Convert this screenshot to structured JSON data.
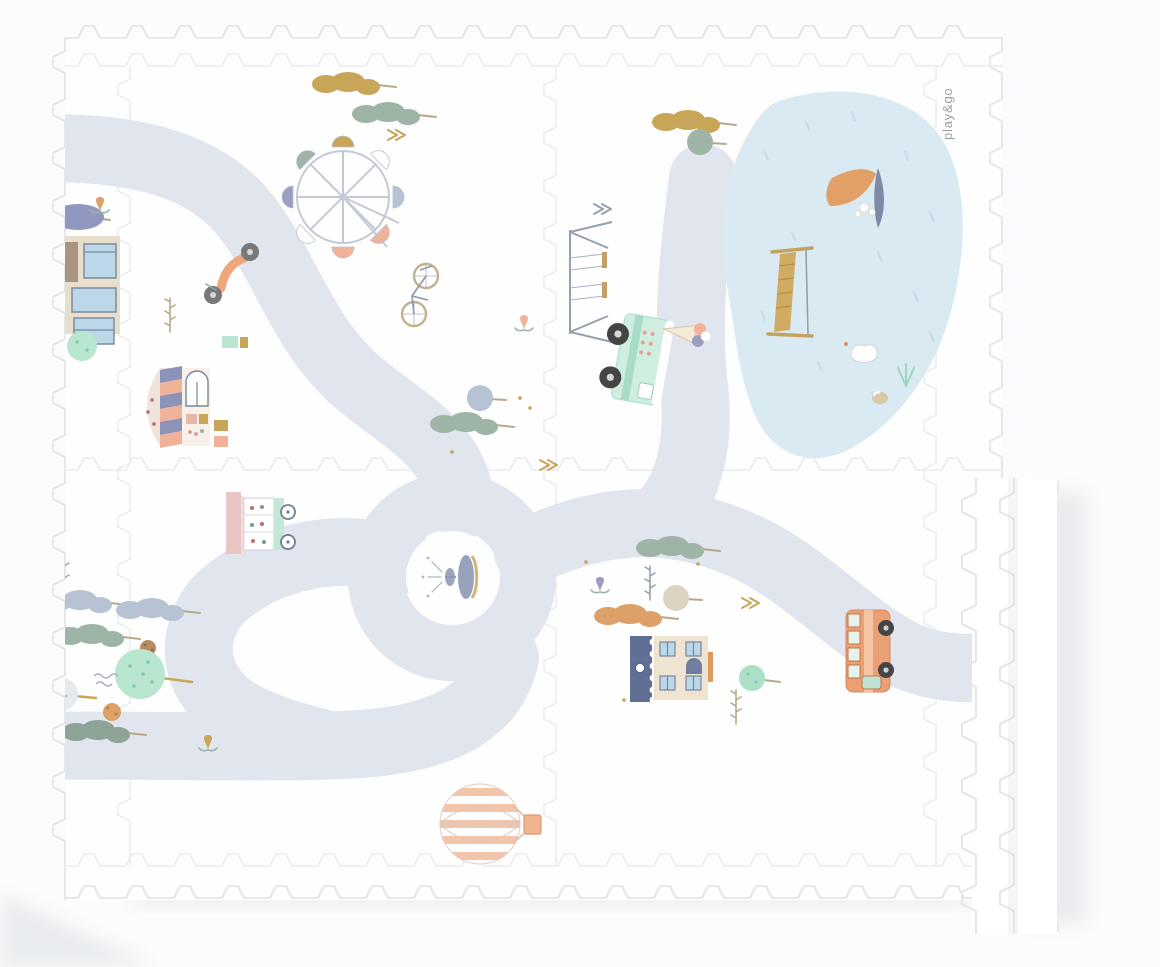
{
  "brand": {
    "logo_text": "play&go"
  },
  "product": {
    "kind": "foam-puzzle-playmat",
    "tiles": 4,
    "illustrations": [
      "road-track",
      "roundabout-fountain",
      "pond",
      "sailboat",
      "swan",
      "duck",
      "slide",
      "swing-set",
      "ferris-wheel",
      "scooter",
      "bicycle",
      "ice-cream-truck",
      "ice-cream-kiosk",
      "flower-cart",
      "house",
      "townhouse",
      "bus",
      "hot-air-balloon",
      "trees",
      "shrubs",
      "tulips",
      "sprigs",
      "border-edge-strips"
    ]
  },
  "colors": {
    "bg": "#fbfcfd",
    "mat": "#fefefe",
    "road": "#e0e5ee",
    "pond": "#d9eaf3",
    "pond_mark": "#c2dcea",
    "joint": "#e9ebef",
    "edgeline": "#e2e6ea",
    "shadow": "#e9ecef",
    "mustard": "#c9a558",
    "sage": "#9db4a6",
    "sagedeep": "#8ca396",
    "greyblue": "#b7c2d2",
    "mint": "#b8e6cf",
    "mintdeep": "#7fc9ab",
    "peach": "#f0b39a",
    "orange": "#dda068",
    "coral": "#eda77a",
    "lavender": "#9a9fc2",
    "slate": "#6f7f9e",
    "slateline": "#95a0ae",
    "beige": "#e9ddcb",
    "beigetree": "#ddd3c2",
    "taupe": "#a89480",
    "blueglass": "#bcd8e8",
    "frame": "#77879c",
    "trunk": "#b9a887",
    "wheel": "#454545",
    "truckmint": "#cfeee0",
    "truckmint2": "#a8dcc6",
    "buspeach": "#eb9f74",
    "busstripe": "#f5c4a4",
    "blush": "#e9c6c4",
    "tan": "#d2ab62",
    "logo": "#94a3b0"
  }
}
